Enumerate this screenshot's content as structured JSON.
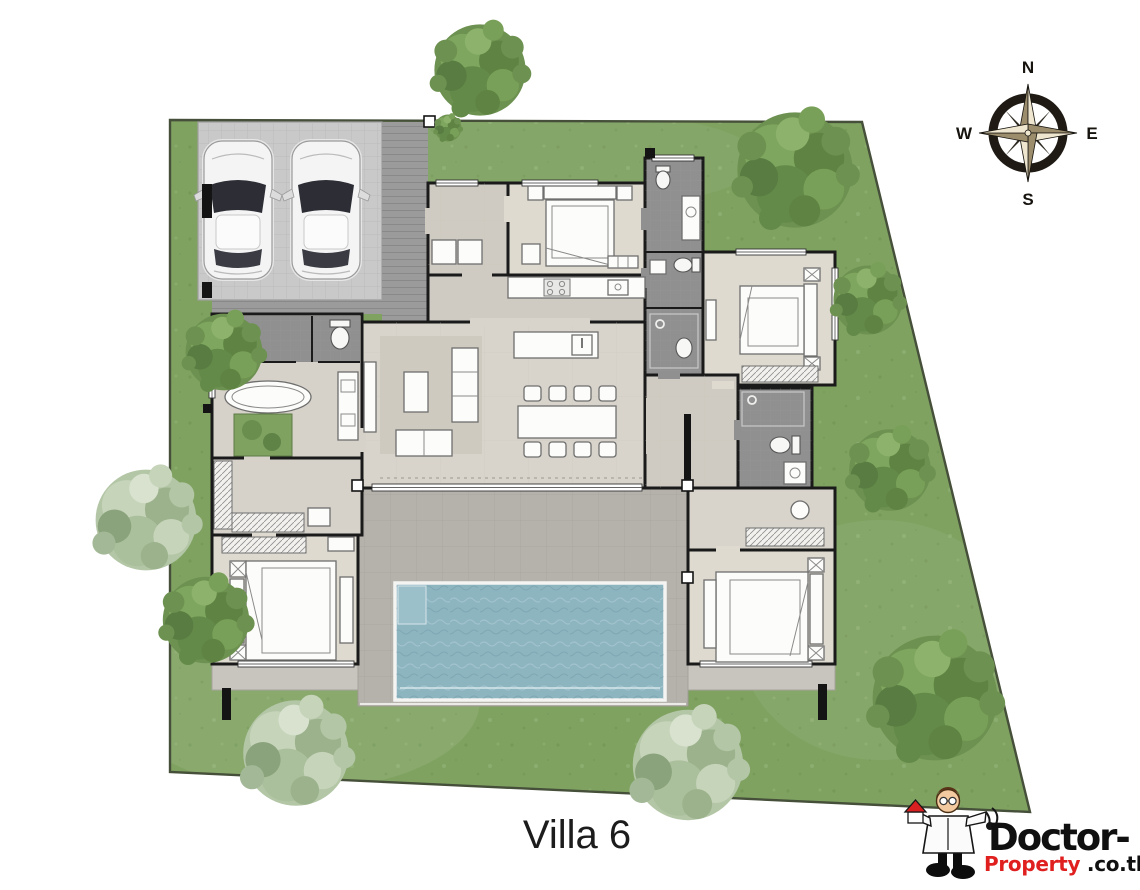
{
  "title": {
    "label": "Villa 6"
  },
  "compass": {
    "n": "N",
    "e": "E",
    "s": "S",
    "w": "W"
  },
  "logo": {
    "line1": "Doctor-",
    "line2_red": "Property",
    "line2_black": ".co.th"
  },
  "colors": {
    "grass": "#7fa261",
    "plot_border": "#454f39",
    "pool_water": "#8db5c0",
    "wall": "#1a1a1a",
    "logo_red": "#e01f1f",
    "title_text": "#1c1c1c"
  },
  "plan": {
    "name": "villa-6-floor-plan",
    "rooms": [
      "carport",
      "entry",
      "bedroom-top",
      "kitchen",
      "great-room-living-dining",
      "master-bathroom",
      "walk-in-closet",
      "bedroom-bottom-left",
      "bathroom-strip",
      "bedroom-right",
      "bathroom-right",
      "dressing-room",
      "bedroom-bottom-right",
      "terrace",
      "swimming-pool",
      "garden"
    ],
    "features": [
      "two-parked-cars",
      "eight-seat-dining-table",
      "l-shaped-sofa",
      "kitchen-island",
      "oval-bathtub",
      "inner-green-courtyard",
      "pool-steps"
    ]
  }
}
